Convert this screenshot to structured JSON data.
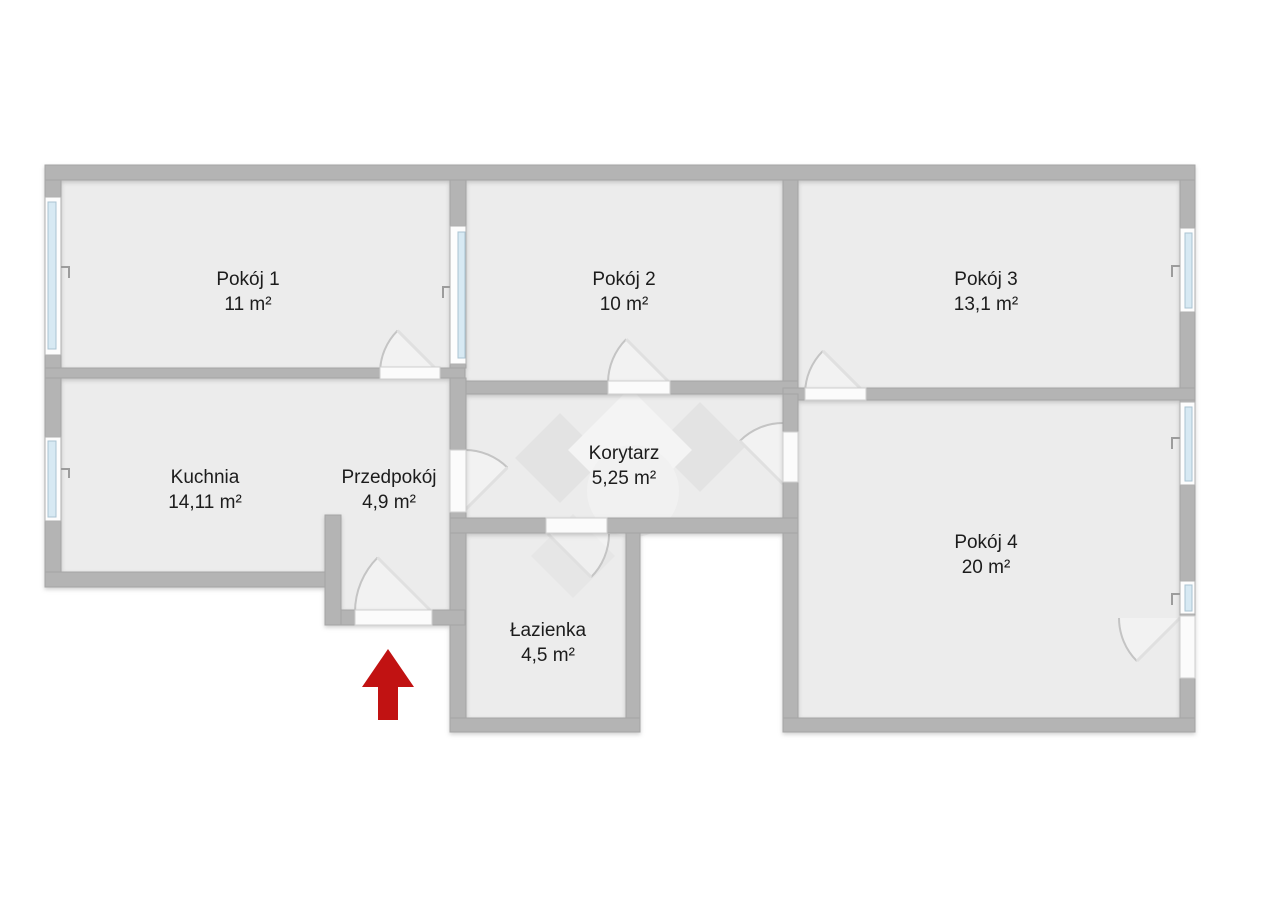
{
  "plan": {
    "type": "floor-plan",
    "rooms": [
      {
        "id": "pokoj1",
        "name": "Pokój 1",
        "area": "11 m²"
      },
      {
        "id": "pokoj2",
        "name": "Pokój 2",
        "area": "10 m²"
      },
      {
        "id": "pokoj3",
        "name": "Pokój 3",
        "area": "13,1 m²"
      },
      {
        "id": "kuchnia",
        "name": "Kuchnia",
        "area": "14,11 m²"
      },
      {
        "id": "przedpokoj",
        "name": "Przedpokój",
        "area": "4,9 m²"
      },
      {
        "id": "korytarz",
        "name": "Korytarz",
        "area": "5,25 m²"
      },
      {
        "id": "lazienka",
        "name": "Łazienka",
        "area": "4,5 m²"
      },
      {
        "id": "pokoj4",
        "name": "Pokój 4",
        "area": "20 m²"
      }
    ],
    "entrance_arrow": {
      "direction": "up",
      "color": "#c11212"
    },
    "colors": {
      "floor": "#ececec",
      "wall": "#b4b4b4",
      "window_glass": "#d7e9f3",
      "opening": "#fbfbfb",
      "watermark_light": "#f4f4f4",
      "watermark_dark": "#e3e3e3",
      "background": "#ffffff"
    }
  }
}
